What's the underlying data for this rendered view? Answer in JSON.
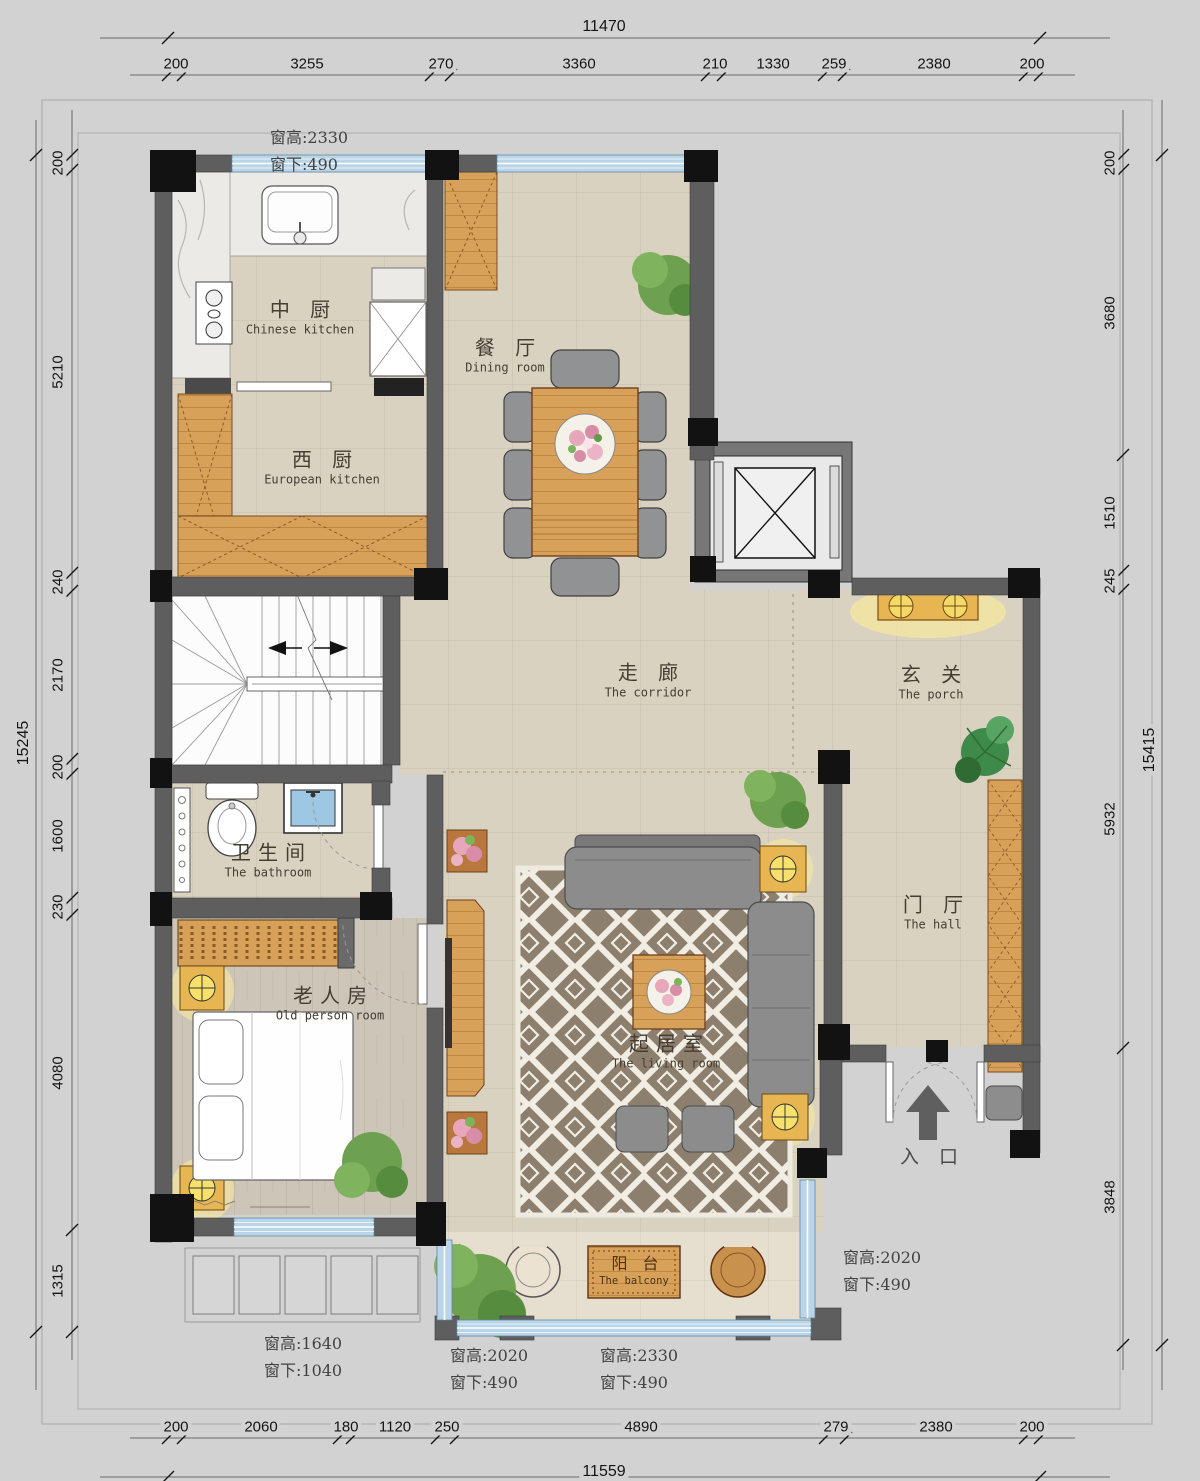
{
  "title": "Residential floor plan",
  "dims": {
    "top_total": "11470",
    "top": [
      "200",
      "3255",
      "270",
      "3360",
      "210",
      "1330",
      "259",
      "2380",
      "200"
    ],
    "bottom": [
      "200",
      "2060",
      "180",
      "1120",
      "250",
      "4890",
      "279",
      "2380",
      "200"
    ],
    "bottom_total": "11559",
    "left_total": "15245",
    "left": [
      "200",
      "5210",
      "240",
      "2170",
      "200",
      "1600",
      "230",
      "4080",
      "1315"
    ],
    "right": [
      "200",
      "3680",
      "1510",
      "245",
      "5932",
      "3848"
    ],
    "right_total": "15415"
  },
  "rooms": {
    "chinese_kitchen": {
      "zh": "中 厨",
      "en": "Chinese kitchen"
    },
    "european_kitchen": {
      "zh": "西 厨",
      "en": "European kitchen"
    },
    "dining": {
      "zh": "餐 厅",
      "en": "Dining room"
    },
    "corridor": {
      "zh": "走 廊",
      "en": "The corridor"
    },
    "porch": {
      "zh": "玄 关",
      "en": "The porch"
    },
    "bathroom": {
      "zh": "卫生间",
      "en": "The bathroom"
    },
    "old_person": {
      "zh": "老人房",
      "en": "Old person room"
    },
    "living": {
      "zh": "起居室",
      "en": "The living room"
    },
    "hall": {
      "zh": "门 厅",
      "en": "The hall"
    },
    "balcony": {
      "zh": "阳 台",
      "en": "The balcony"
    },
    "entrance": {
      "zh": "入 口"
    }
  },
  "window_notes": [
    {
      "l1": "窗高:2330",
      "l2": "窗下:490"
    },
    {
      "l1": "窗高:2020",
      "l2": "窗下:490"
    },
    {
      "l1": "窗高:1640",
      "l2": "窗下:1040"
    },
    {
      "l1": "窗高:2020",
      "l2": "窗下:490"
    },
    {
      "l1": "窗高:2330",
      "l2": "窗下:490"
    }
  ],
  "colors": {
    "background": "#d2d2d2",
    "wall": "#5e5e5e",
    "column": "#121212",
    "window": "#b9d5e7",
    "floor_tile": "#dad2c1",
    "wood": "#d8a159",
    "rug": "#8d7f6e",
    "lamp_glow": "#f6e79e"
  }
}
